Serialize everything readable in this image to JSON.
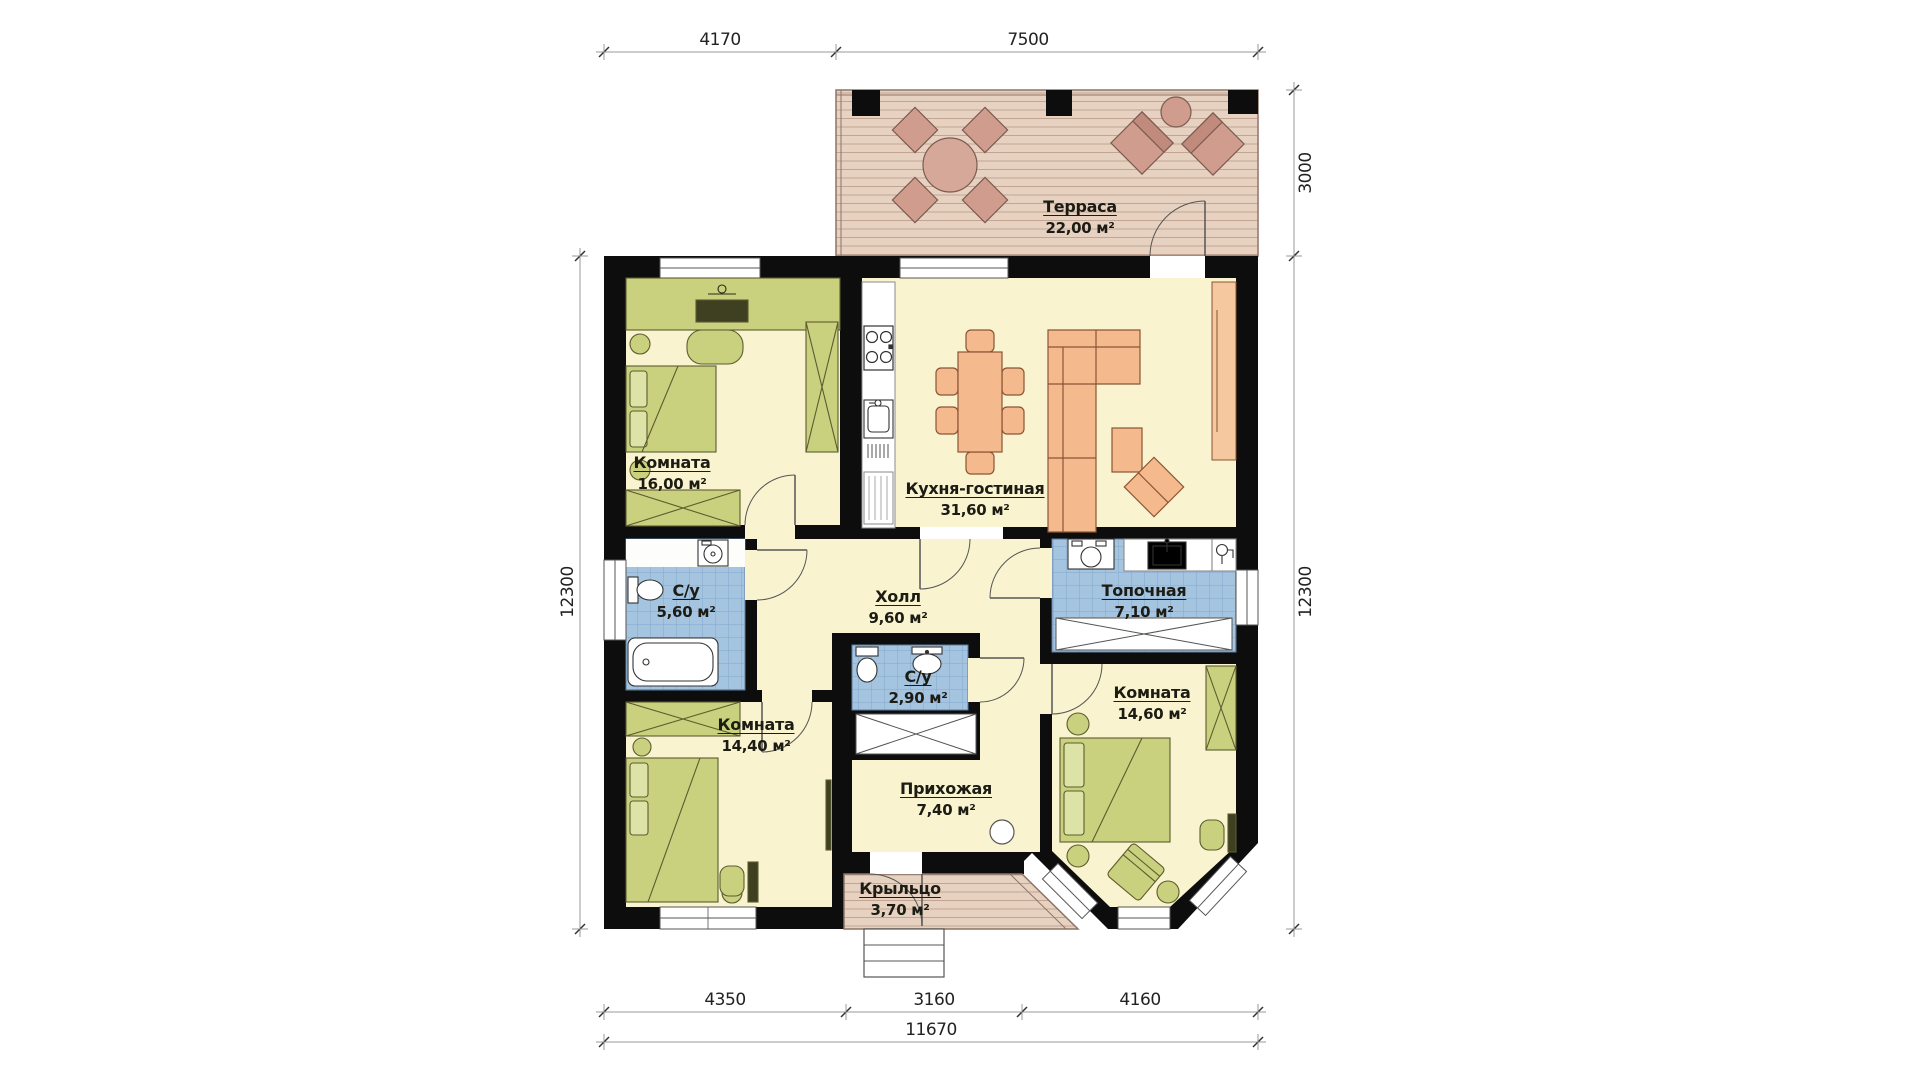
{
  "title": "План одноэтажного дома",
  "rooms": [
    {
      "id": "terrace",
      "name": "Терраса",
      "area": "22,00 м²"
    },
    {
      "id": "room16",
      "name": "Комната",
      "area": "16,00 м²"
    },
    {
      "id": "kitchen",
      "name": "Кухня-гостиная",
      "area": "31,60 м²"
    },
    {
      "id": "bath1",
      "name": "С/у",
      "area": "5,60 м²"
    },
    {
      "id": "hall",
      "name": "Холл",
      "area": "9,60 м²"
    },
    {
      "id": "boiler",
      "name": "Топочная",
      "area": "7,10 м²"
    },
    {
      "id": "bath2",
      "name": "С/у",
      "area": "2,90 м²"
    },
    {
      "id": "room1440",
      "name": "Комната",
      "area": "14,40 м²"
    },
    {
      "id": "hallway",
      "name": "Прихожая",
      "area": "7,40 м²"
    },
    {
      "id": "room1460",
      "name": "Комната",
      "area": "14,60 м²"
    },
    {
      "id": "porch",
      "name": "Крыльцо",
      "area": "3,70 м²"
    }
  ],
  "dimensions": {
    "top": [
      "4170",
      "7500"
    ],
    "right_top": "3000",
    "right_side": "12300",
    "left_side": "12300",
    "bottom": [
      "4350",
      "3160",
      "4160"
    ],
    "overall_width": "11670"
  },
  "colors": {
    "wall": "#0d0d0d",
    "floor_yellow": "#f9f4cf",
    "furniture_olive": "#c9d07e",
    "tile_blue": "#a4c4e0",
    "furniture_orange": "#f4b98c",
    "wood_terrace": "#e7d2c2",
    "terrace_furniture": "#cf9c8e"
  }
}
